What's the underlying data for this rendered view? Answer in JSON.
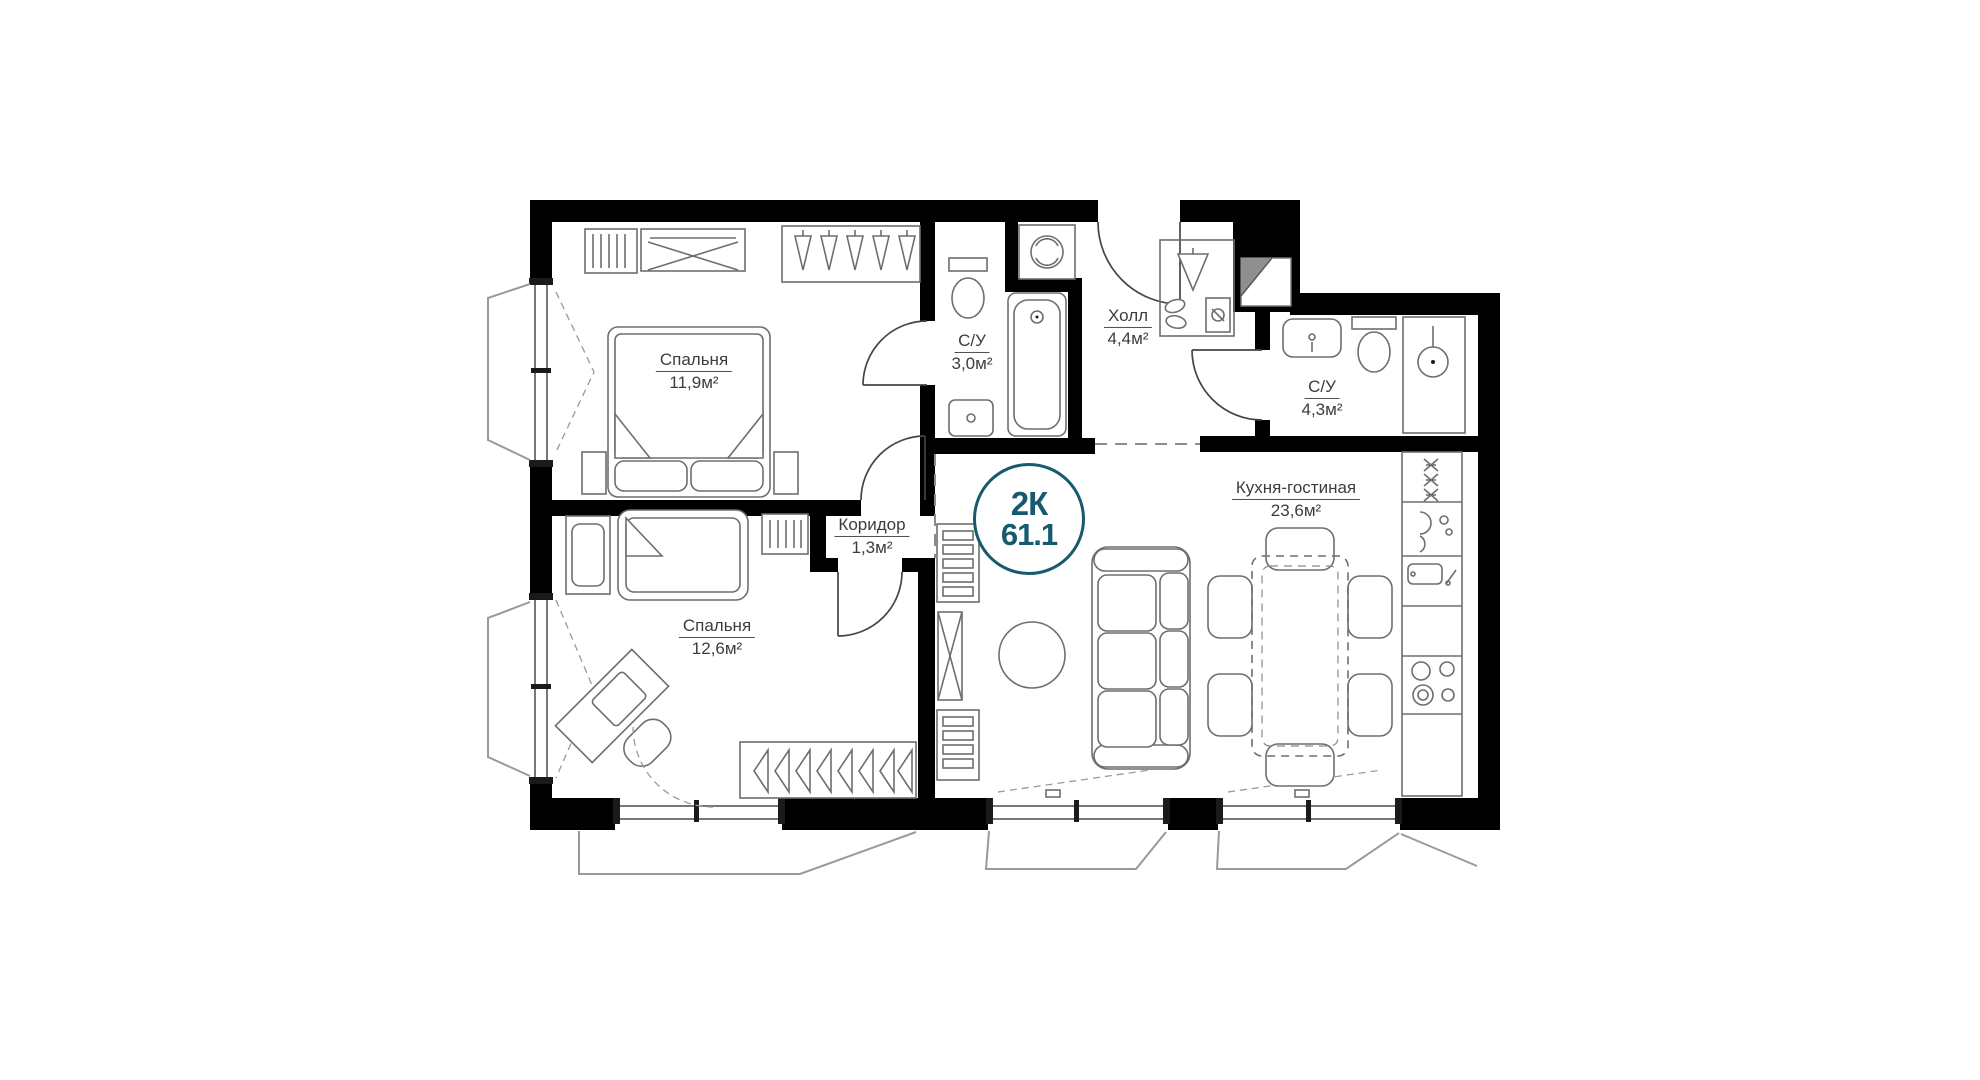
{
  "plan": {
    "badge": {
      "type": "2К",
      "area": "61.1"
    },
    "rooms": [
      {
        "id": "bedroom-1",
        "name": "Спальня",
        "area": "11,9м²"
      },
      {
        "id": "bathroom-1",
        "name": "С/У",
        "area": "3,0м²"
      },
      {
        "id": "hall",
        "name": "Холл",
        "area": "4,4м²"
      },
      {
        "id": "bathroom-2",
        "name": "С/У",
        "area": "4,3м²"
      },
      {
        "id": "kitchen-living",
        "name": "Кухня-гостиная",
        "area": "23,6м²"
      },
      {
        "id": "corridor",
        "name": "Коридор",
        "area": "1,3м²"
      },
      {
        "id": "bedroom-2",
        "name": "Спальня",
        "area": "12,6м²"
      }
    ],
    "colors": {
      "accent": "#175A70",
      "wall": "#000000",
      "furniture_line": "#6E6E6E",
      "label_text": "#3D3D3D"
    }
  }
}
